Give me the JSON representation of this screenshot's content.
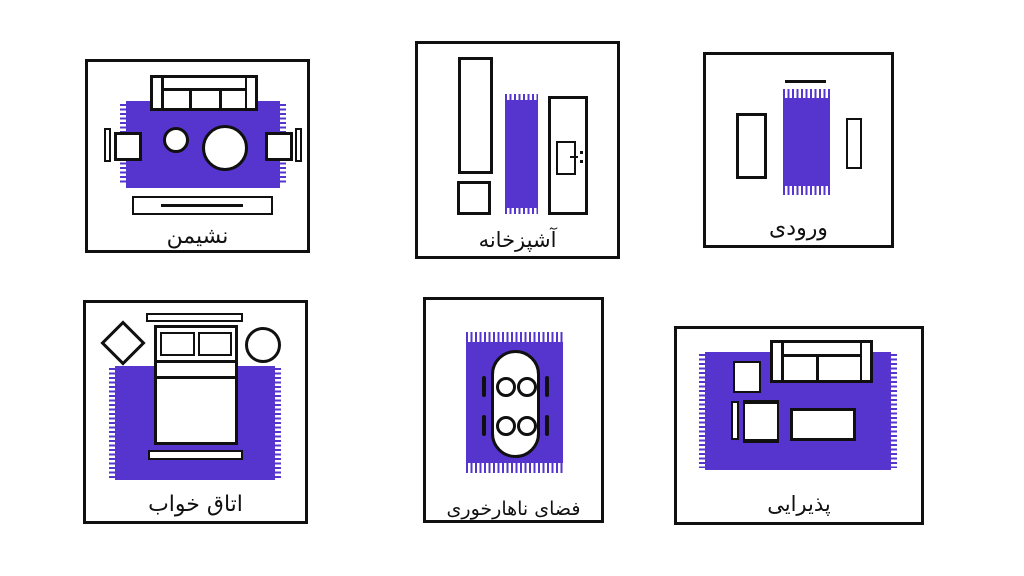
{
  "colors": {
    "rug": "#5535cd",
    "ink": "#101010",
    "bg": "#ffffff"
  },
  "panels": [
    {
      "id": "living-room",
      "label": "نشیمن"
    },
    {
      "id": "kitchen",
      "label": "آشپزخانه"
    },
    {
      "id": "entrance",
      "label": "ورودی"
    },
    {
      "id": "bedroom",
      "label": "اتاق خواب"
    },
    {
      "id": "dining-area",
      "label": "فضای ناهارخوری"
    },
    {
      "id": "reception",
      "label": "پذیرایی"
    }
  ]
}
